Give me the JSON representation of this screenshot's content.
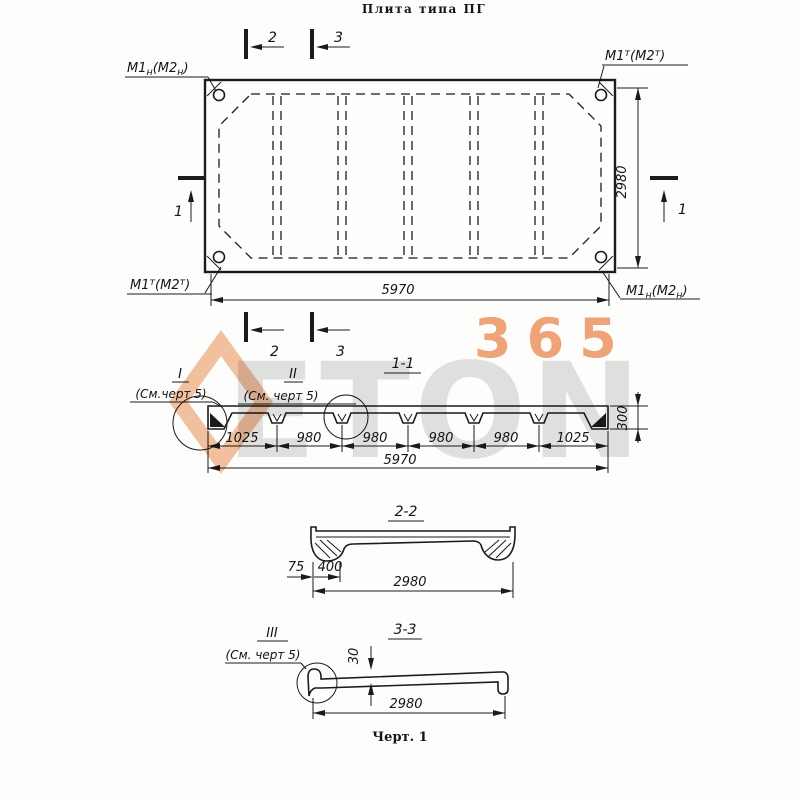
{
  "title": "Плита типа ПГ",
  "caption": "Черт. 1",
  "watermark": {
    "text_gray": "ETON",
    "text_orange": "365"
  },
  "plan": {
    "corner_tl": {
      "a": "M1",
      "a_s": "н",
      "b": "(M2",
      "b_s": "н",
      "c": ")"
    },
    "corner_tr": {
      "a": "M1",
      "a_s": "т",
      "b": "(M2",
      "b_s": "т",
      "c": ")"
    },
    "corner_bl": {
      "a": "M1",
      "a_s": "т",
      "b": "(M2",
      "b_s": "т",
      "c": ")"
    },
    "corner_br": {
      "a": "M1",
      "a_s": "н",
      "b": "(M2",
      "b_s": "н",
      "c": ")"
    },
    "dim_width": "5970",
    "dim_height": "2980",
    "marker1": "1",
    "marker2": "2",
    "marker3": "3"
  },
  "section11": {
    "title": "1-1",
    "detail1": {
      "num": "I",
      "ref": "(См.черт 5)"
    },
    "detail2": {
      "num": "II",
      "ref": "(См. черт 5)"
    },
    "dims": [
      "1025",
      "980",
      "980",
      "980",
      "980",
      "1025"
    ],
    "dim_total": "5970",
    "dim_height": "300"
  },
  "section22": {
    "title": "2-2",
    "dim_lip": "75",
    "dim_end": "400",
    "dim_width": "2980"
  },
  "section33": {
    "title": "3-3",
    "detail": {
      "num": "III",
      "ref": "(См. черт 5)"
    },
    "dim_thickness": "30",
    "dim_width": "2980"
  }
}
